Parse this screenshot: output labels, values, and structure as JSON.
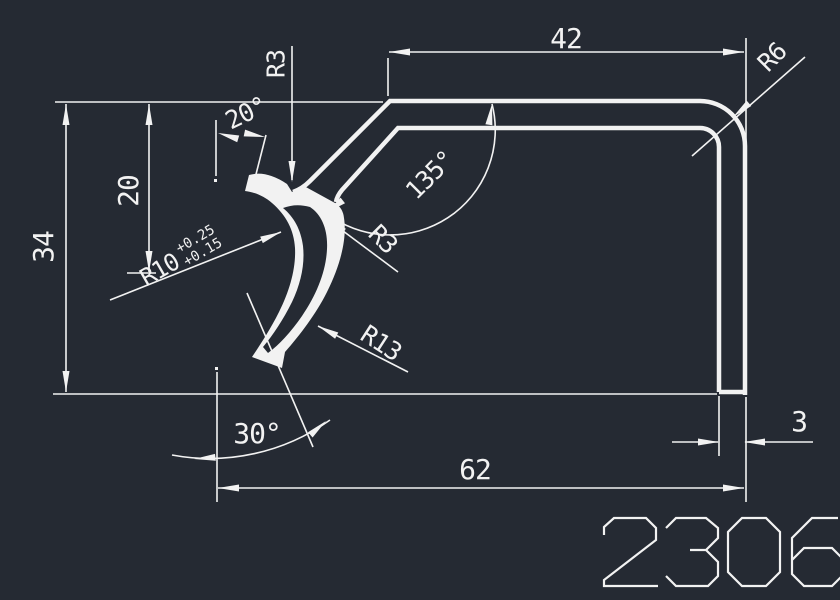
{
  "colors": {
    "background": "#252A33",
    "line": "#F2F2F2"
  },
  "labels": {
    "height_total": "34",
    "height_upper": "20",
    "angle_stub": "20°",
    "radius_notch": "R3",
    "width_top": "42",
    "radius_corner": "R6",
    "angle_bend": "135°",
    "radius_fillet": "R3",
    "radius_hook": "R10",
    "tol_upper": "+0.25",
    "tol_lower": "+0.15",
    "radius_hook_outer": "R13",
    "angle_tip": "30°",
    "width_total": "62",
    "thickness": "3",
    "part_number": "2306"
  }
}
